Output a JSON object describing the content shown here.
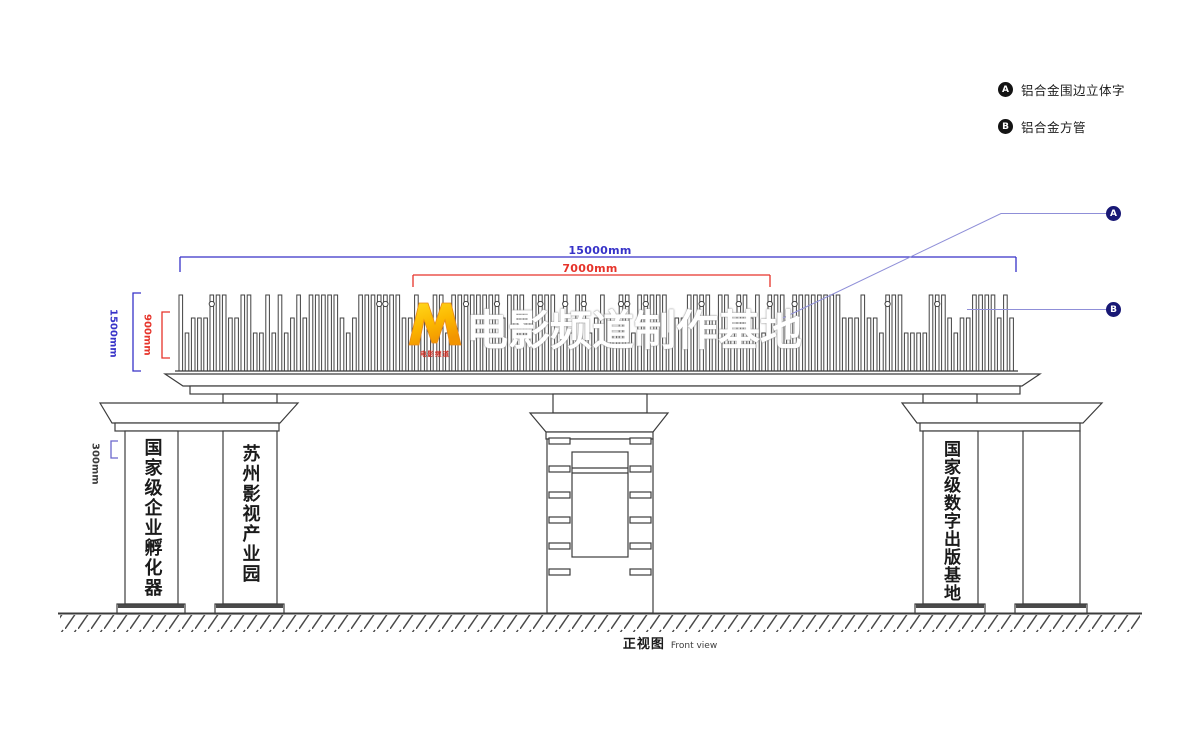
{
  "legend": {
    "items": [
      {
        "key": "A",
        "label": "铝合金围边立体字"
      },
      {
        "key": "B",
        "label": "铝合金方管"
      }
    ]
  },
  "callouts": {
    "a": "A",
    "b": "B"
  },
  "dims": {
    "total": "15000mm",
    "text": "7000mm",
    "height": "1500mm",
    "letter": "900mm",
    "offset": "300mm"
  },
  "sign": {
    "title": "电影频道制作基地",
    "logo_text": "电影频道"
  },
  "pillars": {
    "left_outer": "国家级企业孵化器",
    "left_inner": "苏州影视产业园",
    "right_inner": "国家级数字出版基地"
  },
  "caption": {
    "zh": "正视图",
    "en": "Front view"
  },
  "colors": {
    "dim_blue": "#3732c8",
    "dim_red": "#e6332a",
    "leader_line": "#8f8fd8",
    "callout_navy": "#181875",
    "legend_black": "#141414",
    "line_work": "#3c3c3c",
    "logo_yellow": "#ffd91e",
    "logo_orange": "#f29500",
    "logo_red": "#cf2b20",
    "sign_text": "#ffffff"
  }
}
